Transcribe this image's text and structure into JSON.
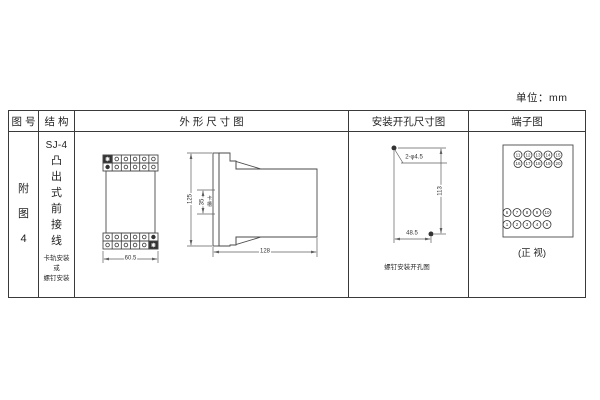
{
  "unit_label": "单位：mm",
  "colors": {
    "background": "#ffffff",
    "line": "#4a4a4a",
    "dim_line": "#5f5f5f",
    "text": "#1f1f1f"
  },
  "table": {
    "headers": {
      "figure_no": "图 号",
      "structure": "结 构",
      "outline": "外 形 尺 寸 图",
      "mounting": "安装开孔尺寸图",
      "terminal": "端子图"
    }
  },
  "figure": {
    "label": "附\n图\n4"
  },
  "structure": {
    "model": "SJ-4",
    "type_vertical": "凸\n出\n式\n前\n接\n线",
    "mount_note": "卡轨安装\n或\n螺钉安装"
  },
  "outline": {
    "front_width": "60.5",
    "height": "125",
    "slot_height": "35",
    "slot_label": "卡\n槽",
    "depth": "128"
  },
  "mounting": {
    "hole_spec": "2-φ4.5",
    "vertical_spacing": "113",
    "horizontal_spacing": "48.5",
    "caption": "螺钉安装开孔图"
  },
  "terminal": {
    "caption": "(正 视)",
    "top_rows": [
      [
        "11",
        "12",
        "13",
        "14",
        "15"
      ],
      [
        "16",
        "17",
        "18",
        "19",
        "20"
      ]
    ],
    "bottom_rows": [
      [
        "6",
        "7",
        "8",
        "9",
        "10"
      ],
      [
        "1",
        "2",
        "3",
        "4",
        "5"
      ]
    ]
  }
}
